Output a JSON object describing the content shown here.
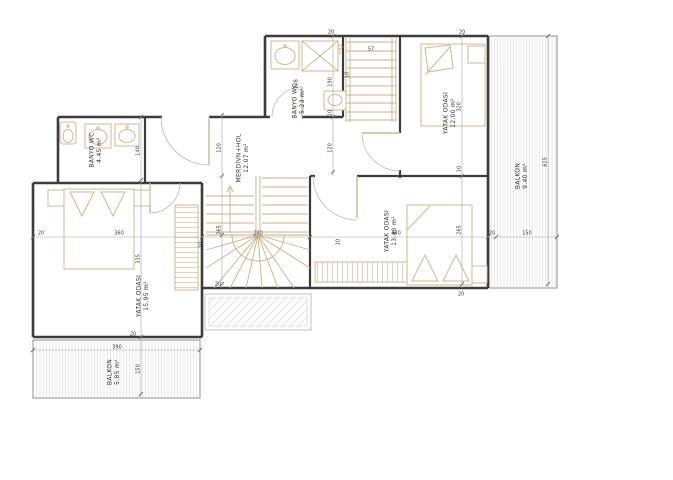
{
  "drawing_type": "architectural floor plan",
  "rooms": {
    "banyo_left": {
      "name": "BANYO WC",
      "area": "4.45 m²"
    },
    "banyo_top": {
      "name": "BANYO WC",
      "area": "5.23 m²"
    },
    "hall": {
      "name": "MERDİVN+HOL",
      "area": "12.07 m²"
    },
    "bedroom_top_right": {
      "name": "YATAK ODASI",
      "area": "12.00 m²"
    },
    "bedroom_mid": {
      "name": "YATAK ODASI",
      "area": "13.40 m²"
    },
    "bedroom_left": {
      "name": "YATAK ODASI",
      "area": "15.95 m²"
    },
    "balcony_right": {
      "name": "BALKON",
      "area": "9.40 m²"
    },
    "balcony_bottom": {
      "name": "BALKON",
      "area": "5.85 m²"
    }
  },
  "dimensions": {
    "d140": "140",
    "d208": "208",
    "d190": "190",
    "d57": "57",
    "d120": "120",
    "d320": "320",
    "d625": "625",
    "d360": "360",
    "d335": "335",
    "d265": "265",
    "d280": "280",
    "d440": "440",
    "d150": "150",
    "d390": "390",
    "d20": "20",
    "d10": "10"
  },
  "colors": {
    "wall": "#3c3c3c",
    "furniture": "#d4b58c",
    "stair": "#cbb084",
    "hatch": "#dcdcdc",
    "dimension": "#a6a6a6",
    "text": "#2f2f2f"
  }
}
